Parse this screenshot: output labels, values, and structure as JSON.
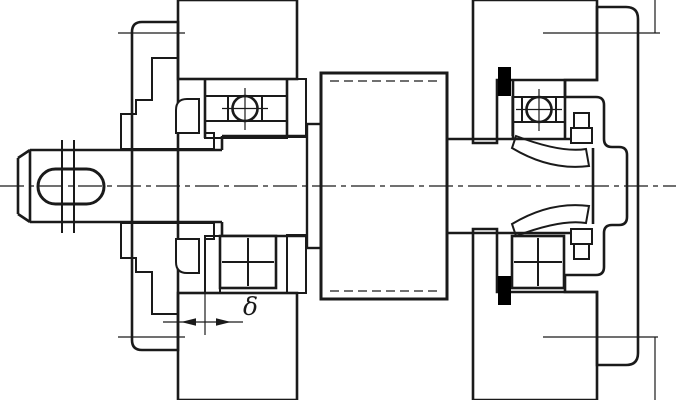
{
  "drawing": {
    "type": "engineering-section-drawing",
    "description": "Shaft and rolling-bearing assembly cross-section with end covers, housing, locknut and adjustment gap",
    "annotations": {
      "delta": "δ"
    },
    "colors": {
      "line": "#1a1a1a",
      "background": "#ffffff",
      "solid_fill": "#000000"
    },
    "parts": [
      "shaft-with-keyway",
      "left-end-cover",
      "right-end-cover",
      "housing-wall",
      "left-ball-bearing",
      "right-ball-bearing",
      "retaining-ring",
      "round-locknut",
      "tab-lock-washer",
      "spacer-collar",
      "hub",
      "seal-bushing",
      "adjustment-gap-delta"
    ]
  }
}
